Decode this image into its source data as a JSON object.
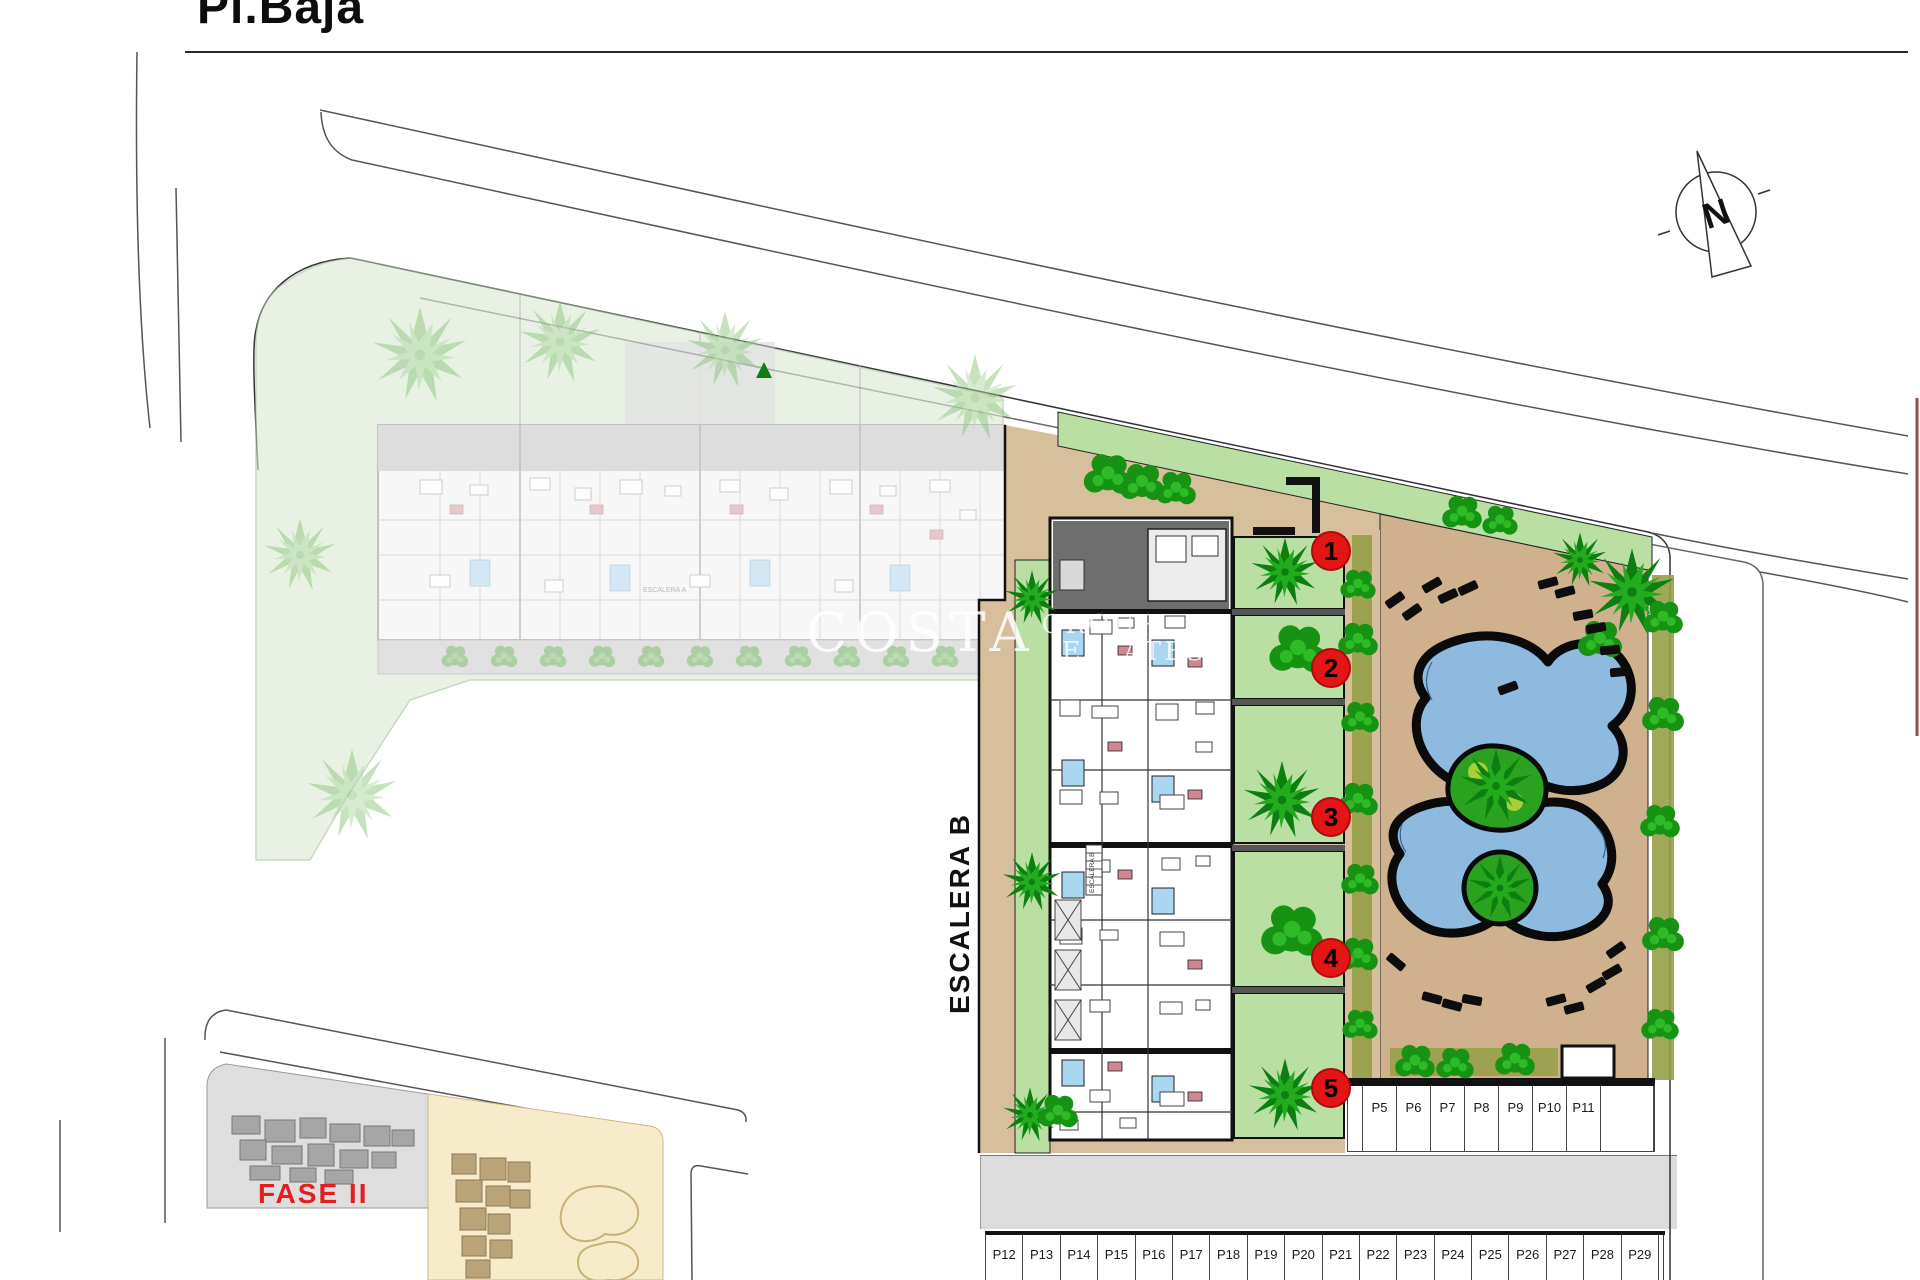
{
  "title": "Pl.Baja",
  "compass_label": "N",
  "watermark": {
    "word1": "COSTA",
    "word2": "GROUP",
    "word3": "ESTATES"
  },
  "labels": {
    "stair_b": "ESCALERA B",
    "stair_a": "ESCALERA A",
    "stair_b_small": "ESCALERA B",
    "phase2": "FASE II"
  },
  "units": [
    "1",
    "2",
    "3",
    "4",
    "5"
  ],
  "parking_upper": [
    "P5",
    "P6",
    "P7",
    "P8",
    "P9",
    "P10",
    "P11"
  ],
  "parking_lower": [
    "P12",
    "P13",
    "P14",
    "P15",
    "P16",
    "P17",
    "P18",
    "P19",
    "P20",
    "P21",
    "P22",
    "P23",
    "P24",
    "P25",
    "P26",
    "P27",
    "P28",
    "P29"
  ],
  "colors": {
    "badge_red": "#e51515",
    "phase_red": "#e31e1e",
    "pool_blue": "#8fbadf",
    "garden_green": "#b9dfa3",
    "palm_green": "#1fa81c",
    "deck_tan": "#cfb28d",
    "courtyard_beige": "#d8bf9b",
    "hedge_olive": "#96a048",
    "road_gray": "#dcdcdc"
  }
}
